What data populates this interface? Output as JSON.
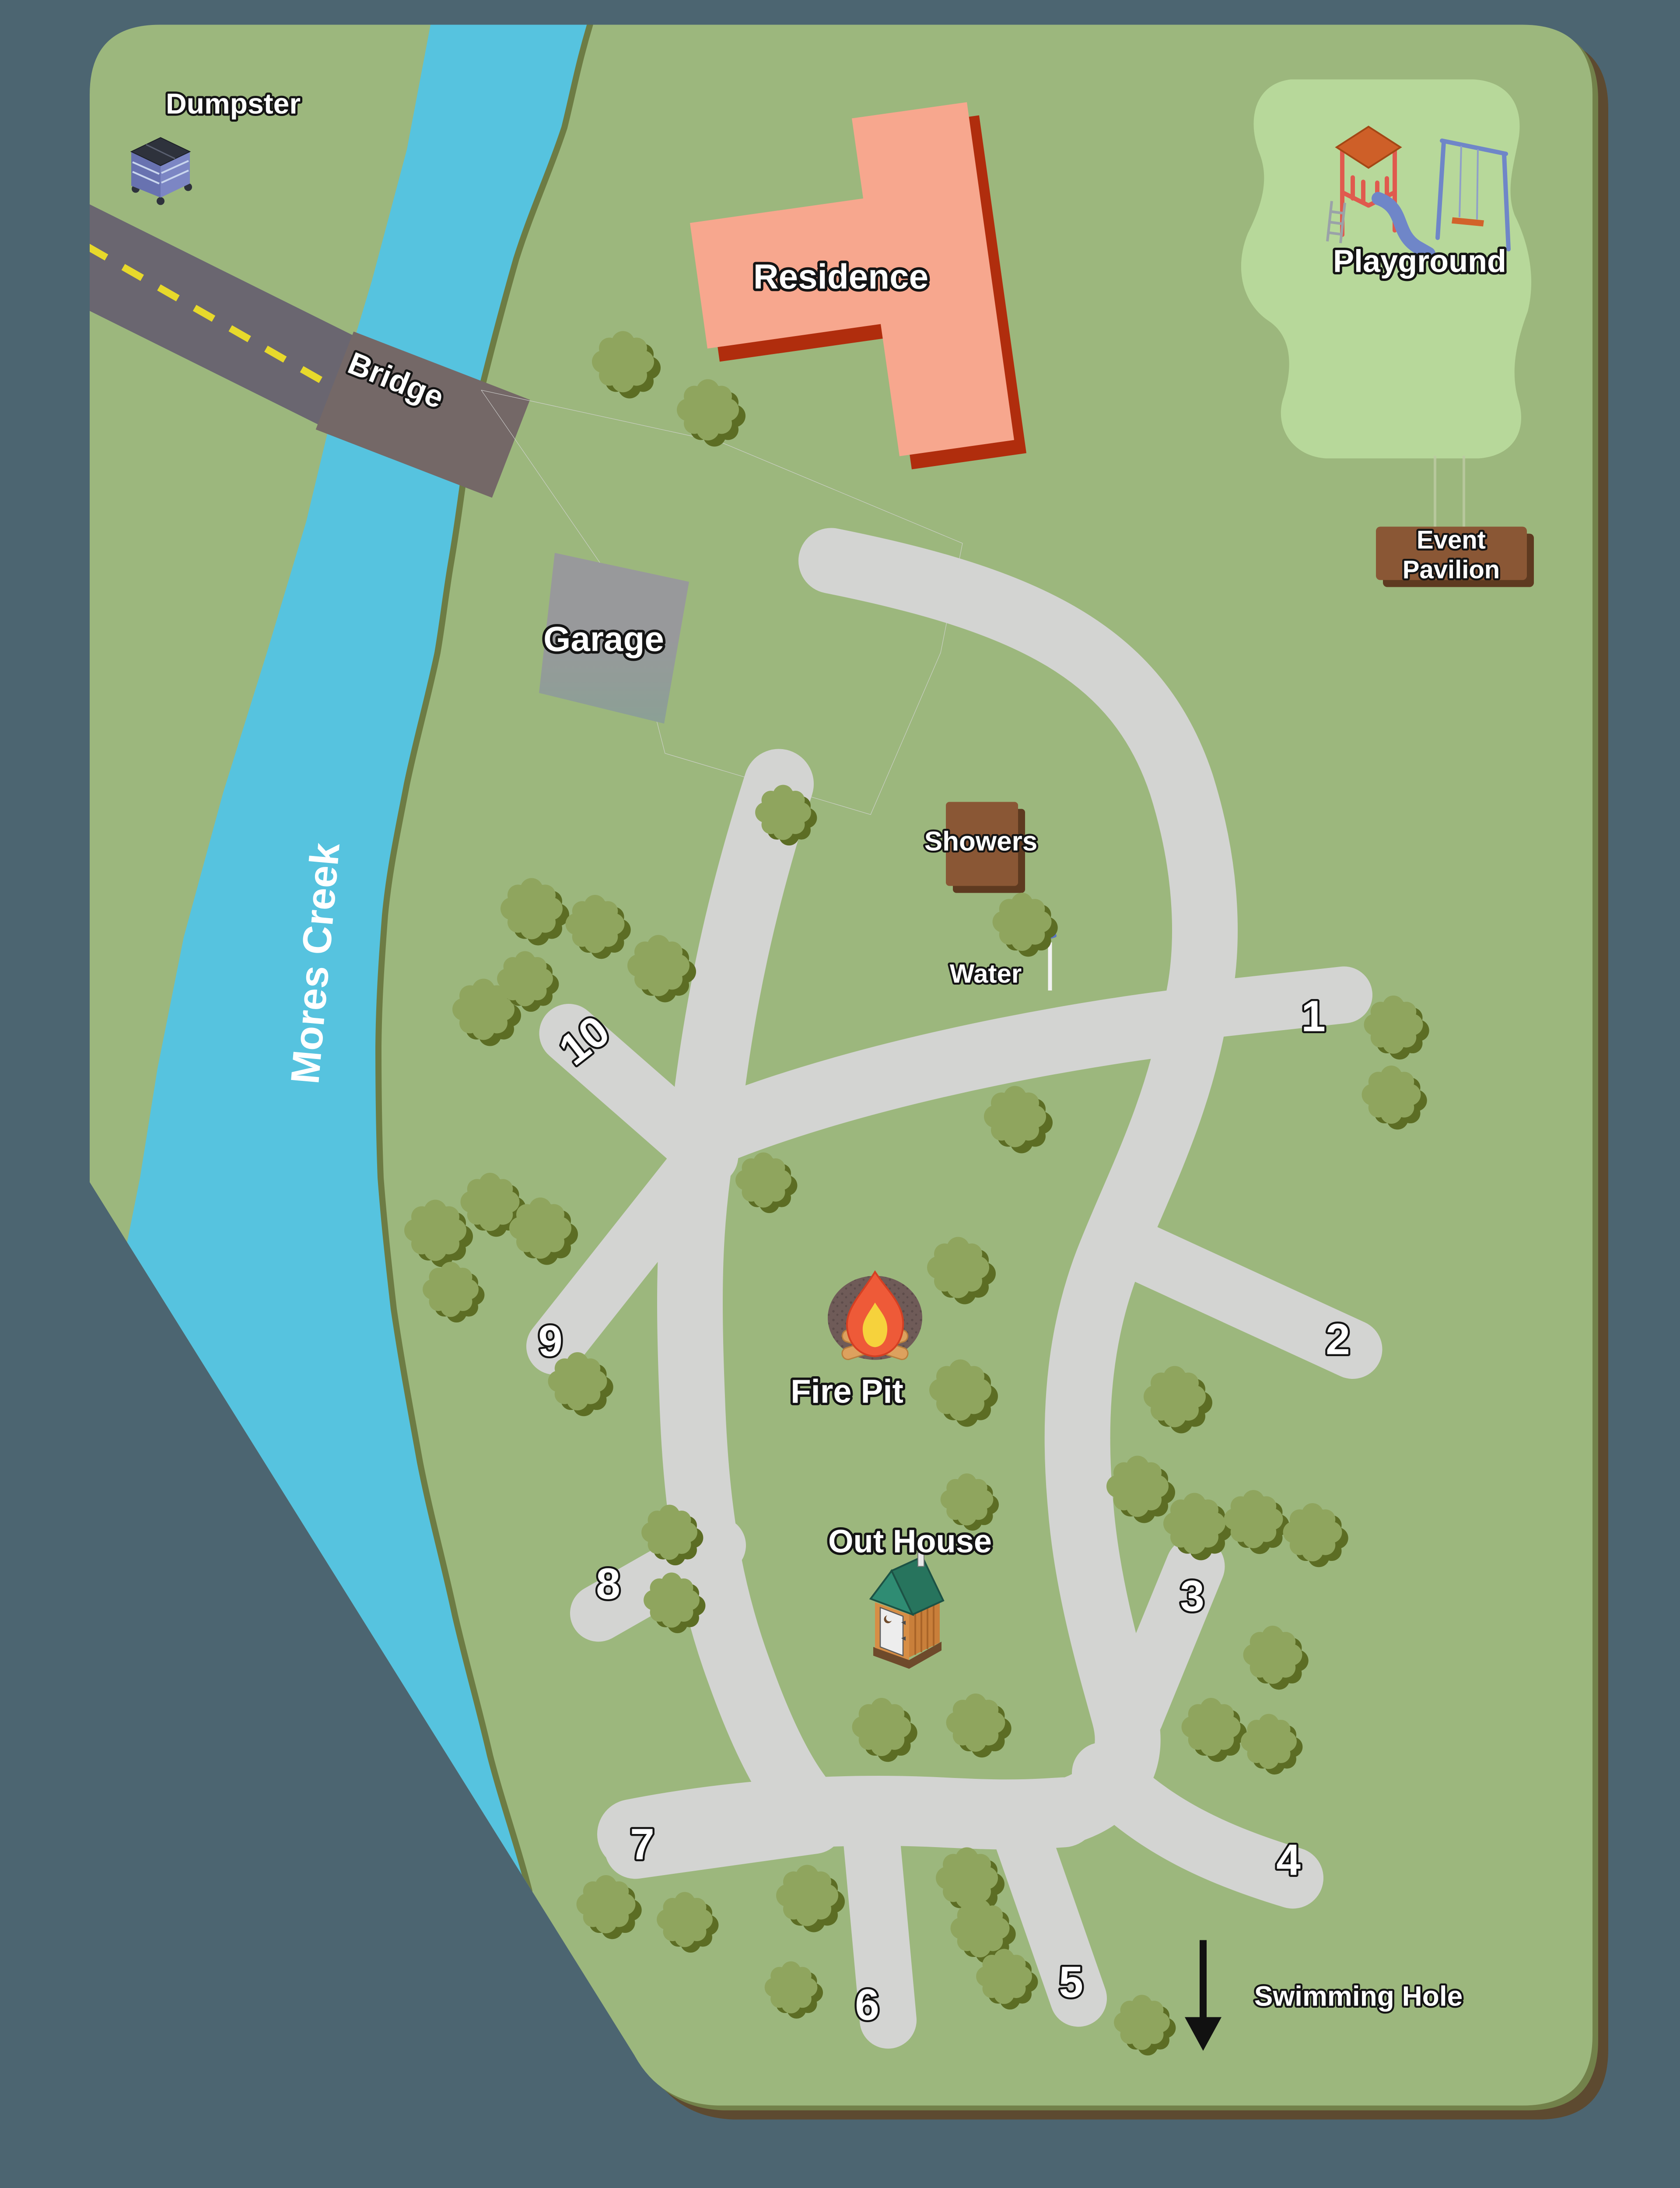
{
  "map": {
    "background_color": "#4C6571",
    "land_color": "#9CB77D",
    "playground_area_color": "#B7D89A",
    "creek_color": "#56C3DF",
    "creek_bank_color": "#6D7C44",
    "road_color": "#D3D4D2",
    "asphalt_color": "#6A6670",
    "bridge_color": "#746867",
    "road_stripe_color": "#E7D92B",
    "border_brown": "#5D4A30",
    "border_olive": "#72814A",
    "residence_color": "#F7A78E",
    "residence_shadow": "#B02D0D",
    "building_brown": "#8A5735",
    "tree_color": "#8FA55E",
    "labels": {
      "creek": "Mores Creek",
      "bridge": "Bridge",
      "dumpster": "Dumpster",
      "residence": "Residence",
      "playground": "Playground",
      "event_pavilion_line1": "Event",
      "event_pavilion_line2": "Pavilion",
      "garage": "Garage",
      "showers": "Showers",
      "water": "Water",
      "fire_pit": "Fire Pit",
      "out_house": "Out House",
      "swimming_hole": "Swimming Hole"
    },
    "campsites": [
      "1",
      "2",
      "3",
      "4",
      "5",
      "6",
      "7",
      "8",
      "9",
      "10"
    ],
    "icons": [
      "dumpster-icon",
      "playground-icon",
      "water-spigot-icon",
      "fire-pit-icon",
      "outhouse-icon",
      "swimming-hole-arrow-icon",
      "tree-icon"
    ]
  }
}
